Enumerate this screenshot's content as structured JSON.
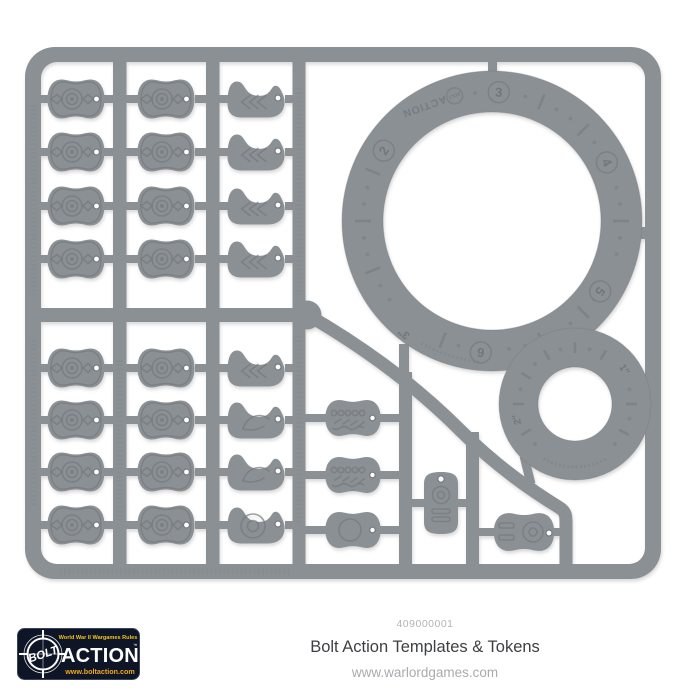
{
  "product": {
    "code": "409000001",
    "title": "Bolt Action Templates & Tokens",
    "website": "www.warlordgames.com"
  },
  "logo": {
    "tagline": "World War II Wargames Rules",
    "bolt": "BOLT",
    "action": "ACTION",
    "trademark": "™",
    "website": "www.boltaction.com"
  },
  "sprue": {
    "large_template": {
      "brand_circle": "BOLT",
      "brand_text": "ACTION",
      "labels": {
        "n2": "2",
        "n3": "3",
        "n4": "4",
        "n5": "5",
        "n6": "6"
      },
      "radius_label": "3″"
    },
    "small_template": {
      "labels": {
        "r1": "1″",
        "r2": "2″"
      }
    },
    "colors": {
      "plastic": "#8b9094",
      "plastic_dark": "#75797d",
      "plastic_light": "#9aa0a4",
      "background": "#ffffff",
      "logo_bg": "#0d1526",
      "logo_yellow": "#f2c21e",
      "logo_orange": "#f0a818",
      "title_text": "#3d3f42",
      "muted_text": "#a8abae"
    }
  }
}
